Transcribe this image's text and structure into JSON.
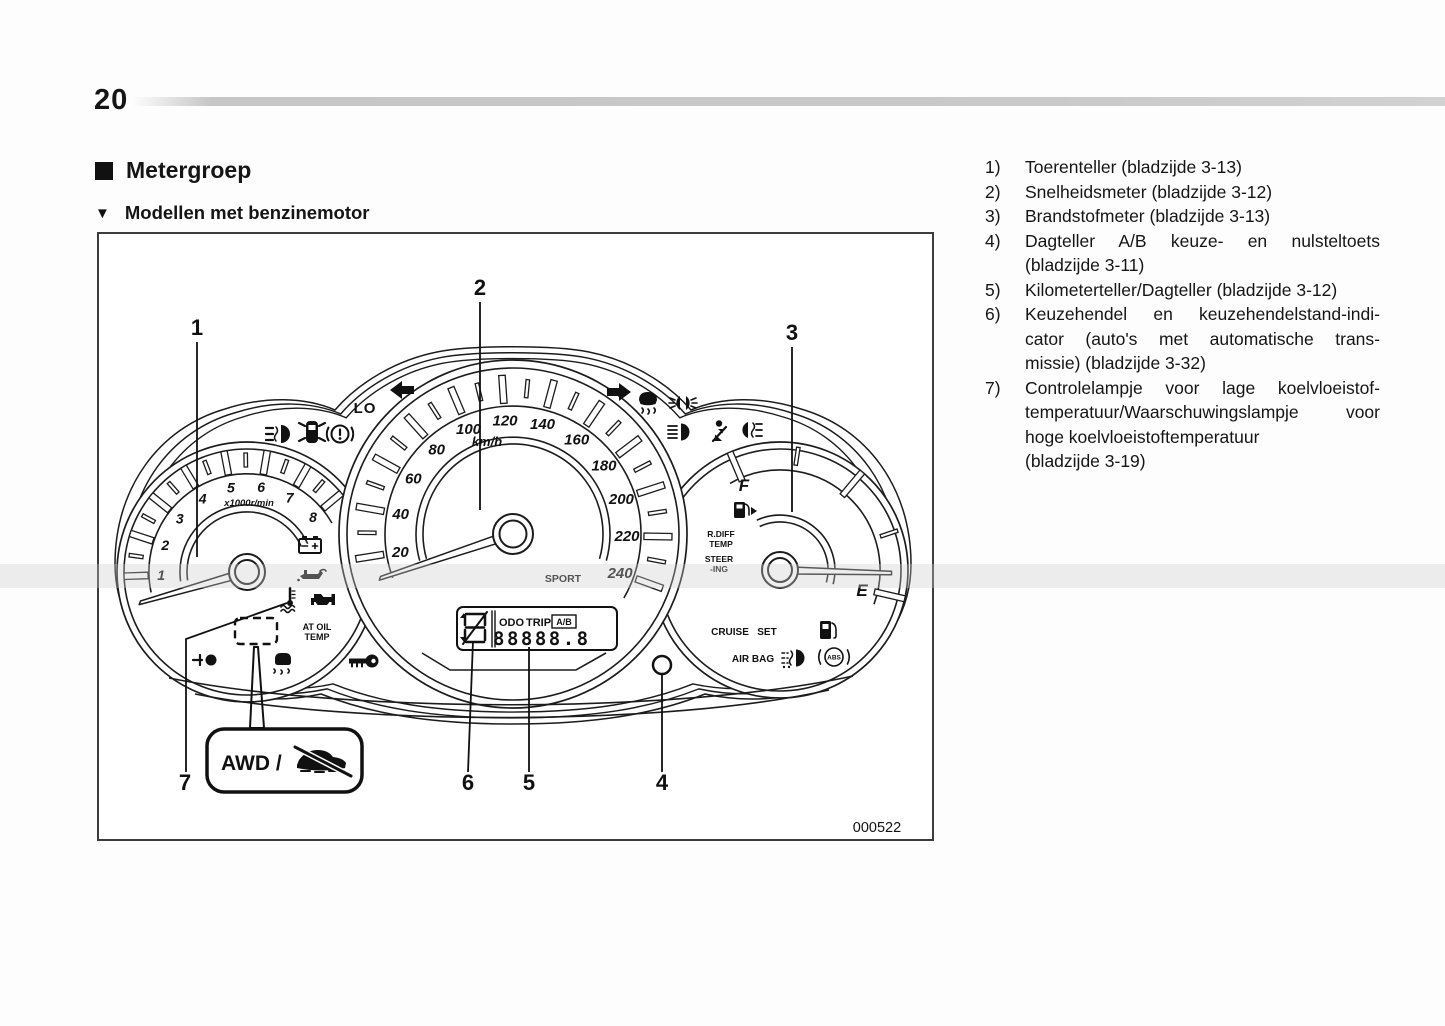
{
  "page": {
    "number": "20",
    "heading": "Metergroep",
    "subheading": "Modellen met benzinemotor"
  },
  "legend": {
    "items": [
      {
        "num": "1)",
        "lines": [
          "Toerenteller (bladzijde 3-13)"
        ],
        "justify": []
      },
      {
        "num": "2)",
        "lines": [
          "Snelheidsmeter (bladzijde 3-12)"
        ],
        "justify": []
      },
      {
        "num": "3)",
        "lines": [
          "Brandstofmeter (bladzijde 3-13)"
        ],
        "justify": []
      },
      {
        "num": "4)",
        "lines": [
          "Dagteller A/B keuze- en nulsteltoets",
          "(bladzijde 3-11)"
        ],
        "justify": [
          0
        ]
      },
      {
        "num": "5)",
        "lines": [
          "Kilometerteller/Dagteller (bladzijde 3-12)"
        ],
        "justify": []
      },
      {
        "num": "6)",
        "lines": [
          "Keuzehendel en keuzehendelstand-indi-",
          "cator (auto's met automatische trans-",
          "missie) (bladzijde 3-32)"
        ],
        "justify": [
          0,
          1
        ]
      },
      {
        "num": "7)",
        "lines": [
          "Controlelampje voor lage koelvloeistof-",
          "temperatuur/Waarschuwingslampje voor",
          "hoge koelvloeistoftemperatuur",
          "(bladzijde 3-19)"
        ],
        "justify": [
          0,
          1
        ]
      }
    ]
  },
  "diagram": {
    "figure_code": "000522",
    "callouts": [
      "1",
      "2",
      "3",
      "4",
      "5",
      "6",
      "7"
    ],
    "tachometer": {
      "labels": [
        "1",
        "2",
        "3",
        "4",
        "5",
        "6",
        "7",
        "8"
      ],
      "unit": "x1000r/min"
    },
    "speedometer": {
      "labels": [
        "20",
        "40",
        "60",
        "80",
        "100",
        "120",
        "140",
        "160",
        "180",
        "200",
        "220",
        "240"
      ],
      "unit": "km/h",
      "mode_label": "SPORT",
      "lo_label": "LO"
    },
    "fuel_gauge": {
      "full": "F",
      "empty": "E"
    },
    "lcd": {
      "odo_label": "ODO",
      "trip_label": "TRIP",
      "ab_label": "A/B",
      "digits": "88888.8"
    },
    "labels": {
      "at_oil_temp_line1": "AT OIL",
      "at_oil_temp_line2": "TEMP",
      "rdiff_line1": "R.DIFF",
      "rdiff_line2": "TEMP",
      "steering_line1": "STEER",
      "steering_line2": "-ING",
      "cruise": "CRUISE",
      "set": "SET",
      "airbag": "AIR BAG",
      "abs": "ABS",
      "awd": "AWD /"
    },
    "icons": {
      "left-turn-signal": "filled left arrow",
      "right-turn-signal": "filled right arrow",
      "front-fog-light-icon": "lamp with wavy beam lines",
      "door-open-icon": "car top view with open doors",
      "brake-warning-icon": "circled exclamation mark",
      "battery-warning-icon": "battery with terminals",
      "oil-pressure-warning-icon": "oil can with drip",
      "coolant-temp-icon": "thermometer over waves",
      "check-engine-icon": "engine block",
      "headlight-leveling-icon": "lamp with level line",
      "vdc-off-icon": "car with skid squiggles",
      "security-key-icon": "key",
      "vdc-indicator-icon": "car with skid squiggles",
      "position-light-icon": "twin lamps with rays",
      "high-beam-icon": "lamp with straight beams",
      "seatbelt-warning-icon": "seated person with belt",
      "rear-fog-light-icon": "lamp with beam lines",
      "fuel-filler-arrow-icon": "fuel pump with arrow",
      "low-fuel-icon": "fuel pump",
      "fog-lamp-dots-icon": "lamp with dotted beams",
      "abs-warning-icon": "ABS in circle with arcs",
      "awd-slip-car-icon": "car with diagonal slash",
      "trip-reset-knob": "small circle button",
      "gear-position-indicator": "segmented display glyph"
    }
  }
}
